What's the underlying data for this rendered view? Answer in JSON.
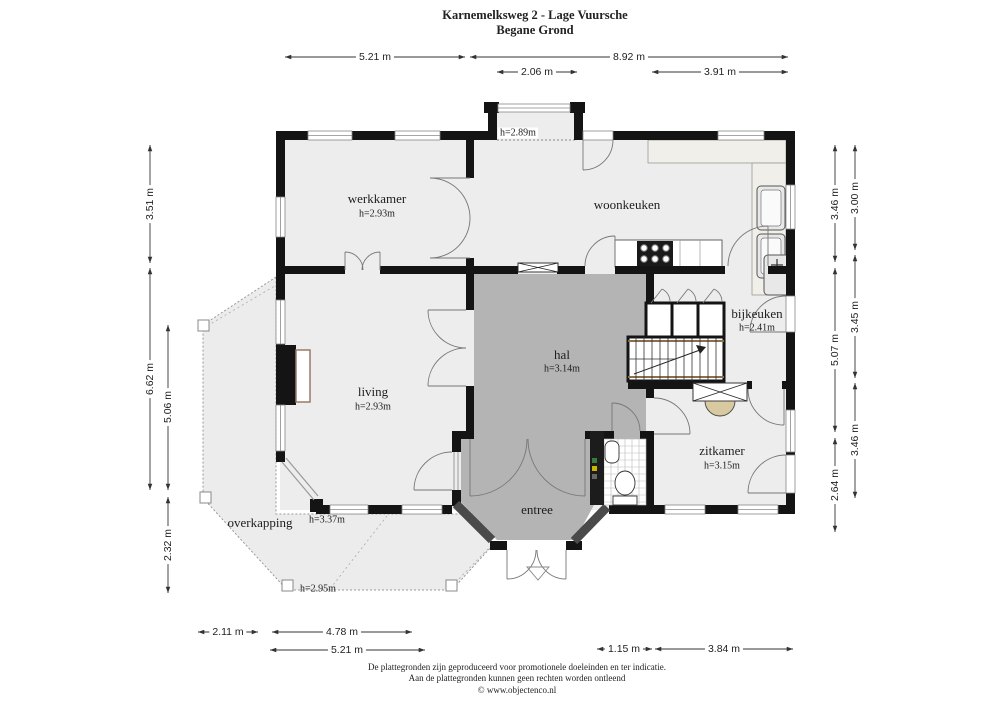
{
  "title": {
    "line1": "Karnemelksweg 2 - Lage Vuursche",
    "line2": "Begane Grond"
  },
  "rooms": {
    "werkkamer": {
      "label": "werkkamer",
      "height": "h=2.93m"
    },
    "woonkeuken": {
      "label": "woonkeuken"
    },
    "bijkeuken": {
      "label": "bijkeuken",
      "height": "h=2.41m"
    },
    "hal": {
      "label": "hal",
      "height": "h=3.14m"
    },
    "living": {
      "label": "living",
      "height": "h=2.93m"
    },
    "zitkamer": {
      "label": "zitkamer",
      "height": "h=3.15m"
    },
    "entree": {
      "label": "entree"
    },
    "overkapping": {
      "label": "overkapping",
      "height_at_house": "h=3.37m",
      "height_at_edge": "h=2.95m"
    },
    "erker": {
      "height": "h=2.89m"
    }
  },
  "dimensions": {
    "top": [
      "5.21 m",
      "8.92 m",
      "2.06 m",
      "3.91 m"
    ],
    "left": [
      "3.51 m",
      "6.62 m",
      "5.06 m",
      "2.32 m"
    ],
    "right_inner": [
      "3.46 m",
      "5.07 m",
      "2.64 m"
    ],
    "right_outer": [
      "3.00 m",
      "3.45 m",
      "3.46 m"
    ],
    "bottom": [
      "2.11 m",
      "4.78 m",
      "5.21 m",
      "1.15 m",
      "3.84 m"
    ]
  },
  "footer": {
    "line1": "De plattegronden zijn geproduceerd voor promotionele doeleinden en ter indicatie.",
    "line2": "Aan de plattegronden kunnen geen rechten worden ontleend",
    "line3": "© www.objectenco.nl"
  },
  "colors": {
    "wall": "#141414",
    "hall_floor": "#b4b4b4",
    "room_floor": "#ededed",
    "veranda_floor": "#ececec",
    "stair_stringer": "#8a6f4e",
    "hearth": "#d9c9a0"
  }
}
